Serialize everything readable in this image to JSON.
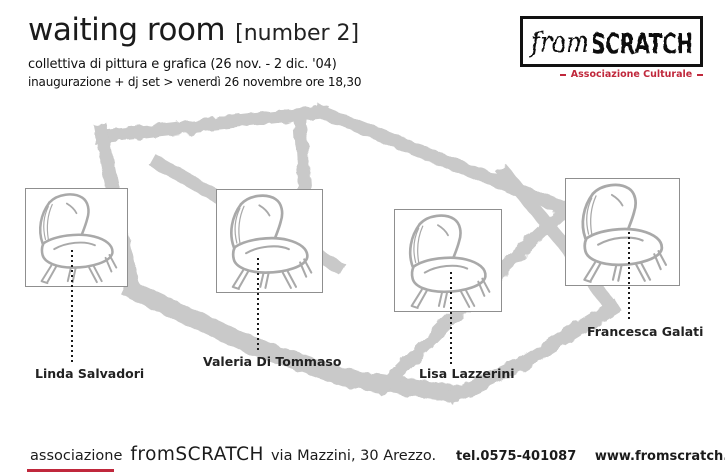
{
  "poster": {
    "title": "waiting room",
    "title_bracket": "[number 2]",
    "subtitle": "collettiva di pittura e grafica (26 nov. - 2 dic. '04)",
    "info_line": "inaugurazione + dj set > venerdì 26 novembre ore 18,30"
  },
  "logo": {
    "name_from": "from",
    "name_scratch": "SCRATCH",
    "tagline": "Associazione Culturale"
  },
  "artists": [
    {
      "name": "Linda Salvadori"
    },
    {
      "name": "Valeria Di Tommaso"
    },
    {
      "name": "Lisa Lazzerini"
    },
    {
      "name": "Francesca Galati"
    }
  ],
  "footer": {
    "org": "associazione",
    "brand": "fromSCRATCH",
    "address": "via Mazzini, 30 Arezzo.",
    "phone": "tel.0575-401087",
    "website": "www.fromscratch.it"
  },
  "colors": {
    "accent_red": "#c0283c",
    "sketch_gray": "#c9c9c9",
    "chair_gray": "#a9a9a9"
  }
}
